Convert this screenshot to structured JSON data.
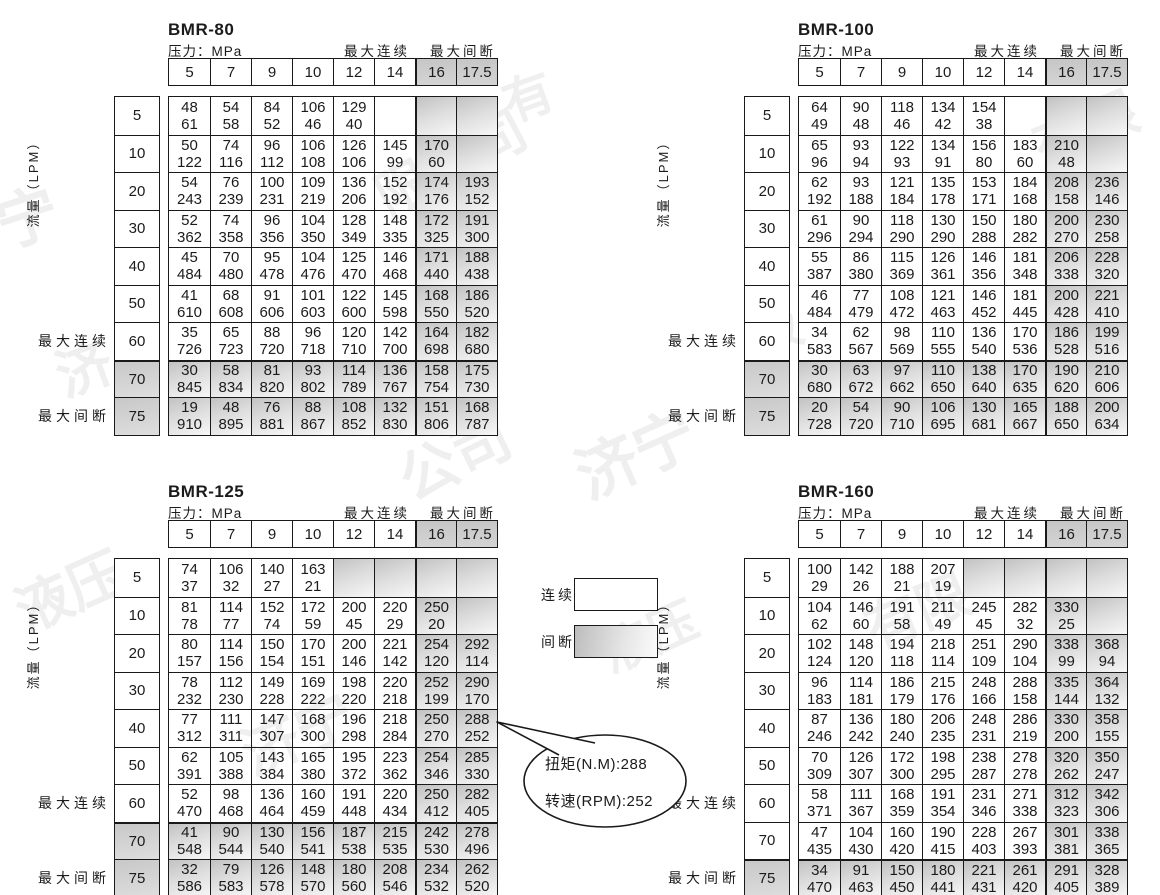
{
  "labels": {
    "pressure": "压力：MPa",
    "max_continuous": "最大连续",
    "max_intermittent": "最大间断",
    "flow": "流量（LPM）"
  },
  "columns": [
    "5",
    "7",
    "9",
    "10",
    "12",
    "14",
    "16",
    "17.5"
  ],
  "rows": [
    "5",
    "10",
    "20",
    "30",
    "40",
    "50",
    "60",
    "70",
    "75"
  ],
  "legend": {
    "continuous": "连续",
    "intermittent": "间断"
  },
  "callout": {
    "torque": "扭矩(N.M):288",
    "speed": "转速(RPM):252"
  },
  "colors": {
    "shade_dark": "#c2c2c2",
    "shade_light": "#f7f7f7",
    "border": "#1a1a1a"
  },
  "watermarks": [
    {
      "text": "宁",
      "x": -5,
      "y": 168,
      "size": 62,
      "rot": -18
    },
    {
      "text": "限公司",
      "x": 368,
      "y": 120,
      "size": 54,
      "rot": -28
    },
    {
      "text": "有",
      "x": 502,
      "y": 58,
      "size": 50,
      "rot": -20
    },
    {
      "text": "有限",
      "x": 1030,
      "y": 85,
      "size": 54,
      "rot": -22
    },
    {
      "text": "济",
      "x": 55,
      "y": 325,
      "size": 56,
      "rot": -20
    },
    {
      "text": "液",
      "x": 745,
      "y": 288,
      "size": 54,
      "rot": -24
    },
    {
      "text": "公司",
      "x": 395,
      "y": 412,
      "size": 58,
      "rot": -26
    },
    {
      "text": "济宁",
      "x": 572,
      "y": 405,
      "size": 62,
      "rot": -24
    },
    {
      "text": "液压",
      "x": 12,
      "y": 548,
      "size": 56,
      "rot": -24
    },
    {
      "text": "液压",
      "x": 598,
      "y": 598,
      "size": 50,
      "rot": -24
    },
    {
      "text": "有限",
      "x": 862,
      "y": 568,
      "size": 54,
      "rot": -22
    },
    {
      "text": "济宁",
      "x": 238,
      "y": 688,
      "size": 58,
      "rot": -24
    }
  ],
  "tables": [
    {
      "title": "BMR-80",
      "shaded_rows": [
        7,
        8
      ],
      "shaded_cols": [
        6,
        7
      ],
      "extra_shaded": [],
      "thick_row": 7,
      "cells": [
        [
          [
            48,
            61
          ],
          [
            54,
            58
          ],
          [
            84,
            52
          ],
          [
            106,
            46
          ],
          [
            129,
            40
          ],
          null,
          null,
          null
        ],
        [
          [
            50,
            122
          ],
          [
            74,
            116
          ],
          [
            96,
            112
          ],
          [
            106,
            108
          ],
          [
            126,
            106
          ],
          [
            145,
            99
          ],
          [
            170,
            60
          ],
          null
        ],
        [
          [
            54,
            243
          ],
          [
            76,
            239
          ],
          [
            100,
            231
          ],
          [
            109,
            219
          ],
          [
            136,
            206
          ],
          [
            152,
            192
          ],
          [
            174,
            176
          ],
          [
            193,
            152
          ]
        ],
        [
          [
            52,
            362
          ],
          [
            74,
            358
          ],
          [
            96,
            356
          ],
          [
            104,
            350
          ],
          [
            128,
            349
          ],
          [
            148,
            335
          ],
          [
            172,
            325
          ],
          [
            191,
            300
          ]
        ],
        [
          [
            45,
            484
          ],
          [
            70,
            480
          ],
          [
            95,
            478
          ],
          [
            104,
            476
          ],
          [
            125,
            470
          ],
          [
            146,
            468
          ],
          [
            171,
            440
          ],
          [
            188,
            438
          ]
        ],
        [
          [
            41,
            610
          ],
          [
            68,
            608
          ],
          [
            91,
            606
          ],
          [
            101,
            603
          ],
          [
            122,
            600
          ],
          [
            145,
            598
          ],
          [
            168,
            550
          ],
          [
            186,
            520
          ]
        ],
        [
          [
            35,
            726
          ],
          [
            65,
            723
          ],
          [
            88,
            720
          ],
          [
            96,
            718
          ],
          [
            120,
            710
          ],
          [
            142,
            700
          ],
          [
            164,
            698
          ],
          [
            182,
            680
          ]
        ],
        [
          [
            30,
            845
          ],
          [
            58,
            834
          ],
          [
            81,
            820
          ],
          [
            93,
            802
          ],
          [
            114,
            789
          ],
          [
            136,
            767
          ],
          [
            158,
            754
          ],
          [
            175,
            730
          ]
        ],
        [
          [
            19,
            910
          ],
          [
            48,
            895
          ],
          [
            76,
            881
          ],
          [
            88,
            867
          ],
          [
            108,
            852
          ],
          [
            132,
            830
          ],
          [
            151,
            806
          ],
          [
            168,
            787
          ]
        ]
      ]
    },
    {
      "title": "BMR-100",
      "shaded_rows": [
        7,
        8
      ],
      "shaded_cols": [
        6,
        7
      ],
      "extra_shaded": [],
      "thick_row": 7,
      "cells": [
        [
          [
            64,
            49
          ],
          [
            90,
            48
          ],
          [
            118,
            46
          ],
          [
            134,
            42
          ],
          [
            154,
            38
          ],
          null,
          null,
          null
        ],
        [
          [
            65,
            96
          ],
          [
            93,
            94
          ],
          [
            122,
            93
          ],
          [
            134,
            91
          ],
          [
            156,
            80
          ],
          [
            183,
            60
          ],
          [
            210,
            48
          ],
          null
        ],
        [
          [
            62,
            192
          ],
          [
            93,
            188
          ],
          [
            121,
            184
          ],
          [
            135,
            178
          ],
          [
            153,
            171
          ],
          [
            184,
            168
          ],
          [
            208,
            158
          ],
          [
            236,
            146
          ]
        ],
        [
          [
            61,
            296
          ],
          [
            90,
            294
          ],
          [
            118,
            290
          ],
          [
            130,
            290
          ],
          [
            150,
            288
          ],
          [
            180,
            282
          ],
          [
            200,
            270
          ],
          [
            230,
            258
          ]
        ],
        [
          [
            55,
            387
          ],
          [
            86,
            380
          ],
          [
            115,
            369
          ],
          [
            126,
            361
          ],
          [
            146,
            356
          ],
          [
            181,
            348
          ],
          [
            206,
            338
          ],
          [
            228,
            320
          ]
        ],
        [
          [
            46,
            484
          ],
          [
            77,
            479
          ],
          [
            108,
            472
          ],
          [
            121,
            463
          ],
          [
            146,
            452
          ],
          [
            181,
            445
          ],
          [
            200,
            428
          ],
          [
            221,
            410
          ]
        ],
        [
          [
            34,
            583
          ],
          [
            62,
            567
          ],
          [
            98,
            569
          ],
          [
            110,
            555
          ],
          [
            136,
            540
          ],
          [
            170,
            536
          ],
          [
            186,
            528
          ],
          [
            199,
            516
          ]
        ],
        [
          [
            30,
            680
          ],
          [
            63,
            672
          ],
          [
            97,
            662
          ],
          [
            110,
            650
          ],
          [
            138,
            640
          ],
          [
            170,
            635
          ],
          [
            190,
            620
          ],
          [
            210,
            606
          ]
        ],
        [
          [
            20,
            728
          ],
          [
            54,
            720
          ],
          [
            90,
            710
          ],
          [
            106,
            695
          ],
          [
            130,
            681
          ],
          [
            165,
            667
          ],
          [
            188,
            650
          ],
          [
            200,
            634
          ]
        ]
      ]
    },
    {
      "title": "BMR-125",
      "shaded_rows": [
        7,
        8
      ],
      "shaded_cols": [
        6,
        7
      ],
      "extra_shaded": [
        [
          0,
          4
        ],
        [
          0,
          5
        ]
      ],
      "thick_row": 7,
      "cells": [
        [
          [
            74,
            37
          ],
          [
            106,
            32
          ],
          [
            140,
            27
          ],
          [
            163,
            21
          ],
          null,
          null,
          null,
          null
        ],
        [
          [
            81,
            78
          ],
          [
            114,
            77
          ],
          [
            152,
            74
          ],
          [
            172,
            59
          ],
          [
            200,
            45
          ],
          [
            220,
            29
          ],
          [
            250,
            20
          ],
          null
        ],
        [
          [
            80,
            157
          ],
          [
            114,
            156
          ],
          [
            150,
            154
          ],
          [
            170,
            151
          ],
          [
            200,
            146
          ],
          [
            221,
            142
          ],
          [
            254,
            120
          ],
          [
            292,
            114
          ]
        ],
        [
          [
            78,
            232
          ],
          [
            112,
            230
          ],
          [
            149,
            228
          ],
          [
            169,
            222
          ],
          [
            198,
            220
          ],
          [
            220,
            218
          ],
          [
            252,
            199
          ],
          [
            290,
            170
          ]
        ],
        [
          [
            77,
            312
          ],
          [
            111,
            311
          ],
          [
            147,
            307
          ],
          [
            168,
            300
          ],
          [
            196,
            298
          ],
          [
            218,
            284
          ],
          [
            250,
            270
          ],
          [
            288,
            252
          ]
        ],
        [
          [
            62,
            391
          ],
          [
            105,
            388
          ],
          [
            143,
            384
          ],
          [
            165,
            380
          ],
          [
            195,
            372
          ],
          [
            223,
            362
          ],
          [
            254,
            346
          ],
          [
            285,
            330
          ]
        ],
        [
          [
            52,
            470
          ],
          [
            98,
            468
          ],
          [
            136,
            464
          ],
          [
            160,
            459
          ],
          [
            191,
            448
          ],
          [
            220,
            434
          ],
          [
            250,
            412
          ],
          [
            282,
            405
          ]
        ],
        [
          [
            41,
            548
          ],
          [
            90,
            544
          ],
          [
            130,
            540
          ],
          [
            156,
            541
          ],
          [
            187,
            538
          ],
          [
            215,
            535
          ],
          [
            242,
            530
          ],
          [
            278,
            496
          ]
        ],
        [
          [
            32,
            586
          ],
          [
            79,
            583
          ],
          [
            126,
            578
          ],
          [
            148,
            570
          ],
          [
            180,
            560
          ],
          [
            208,
            546
          ],
          [
            234,
            532
          ],
          [
            262,
            520
          ]
        ]
      ]
    },
    {
      "title": "BMR-160",
      "shaded_rows": [
        8
      ],
      "shaded_cols": [
        6,
        7
      ],
      "extra_shaded": [
        [
          0,
          4
        ],
        [
          0,
          5
        ]
      ],
      "thick_row": 8,
      "cells": [
        [
          [
            100,
            29
          ],
          [
            142,
            26
          ],
          [
            188,
            21
          ],
          [
            207,
            19
          ],
          null,
          null,
          null,
          null
        ],
        [
          [
            104,
            62
          ],
          [
            146,
            60
          ],
          [
            191,
            58
          ],
          [
            211,
            49
          ],
          [
            245,
            45
          ],
          [
            282,
            32
          ],
          [
            330,
            25
          ],
          null
        ],
        [
          [
            102,
            124
          ],
          [
            148,
            120
          ],
          [
            194,
            118
          ],
          [
            218,
            114
          ],
          [
            251,
            109
          ],
          [
            290,
            104
          ],
          [
            338,
            99
          ],
          [
            368,
            94
          ]
        ],
        [
          [
            96,
            183
          ],
          [
            114,
            181
          ],
          [
            186,
            179
          ],
          [
            215,
            176
          ],
          [
            248,
            166
          ],
          [
            288,
            158
          ],
          [
            335,
            144
          ],
          [
            364,
            132
          ]
        ],
        [
          [
            87,
            246
          ],
          [
            136,
            242
          ],
          [
            180,
            240
          ],
          [
            206,
            235
          ],
          [
            248,
            231
          ],
          [
            286,
            219
          ],
          [
            330,
            200
          ],
          [
            358,
            155
          ]
        ],
        [
          [
            70,
            309
          ],
          [
            126,
            307
          ],
          [
            172,
            300
          ],
          [
            198,
            295
          ],
          [
            238,
            287
          ],
          [
            278,
            278
          ],
          [
            320,
            262
          ],
          [
            350,
            247
          ]
        ],
        [
          [
            58,
            371
          ],
          [
            111,
            367
          ],
          [
            168,
            359
          ],
          [
            191,
            354
          ],
          [
            231,
            346
          ],
          [
            271,
            338
          ],
          [
            312,
            323
          ],
          [
            342,
            306
          ]
        ],
        [
          [
            47,
            435
          ],
          [
            104,
            430
          ],
          [
            160,
            420
          ],
          [
            190,
            415
          ],
          [
            228,
            403
          ],
          [
            267,
            393
          ],
          [
            301,
            381
          ],
          [
            338,
            365
          ]
        ],
        [
          [
            34,
            470
          ],
          [
            91,
            463
          ],
          [
            150,
            450
          ],
          [
            180,
            441
          ],
          [
            221,
            431
          ],
          [
            261,
            420
          ],
          [
            291,
            405
          ],
          [
            328,
            389
          ]
        ]
      ]
    }
  ]
}
